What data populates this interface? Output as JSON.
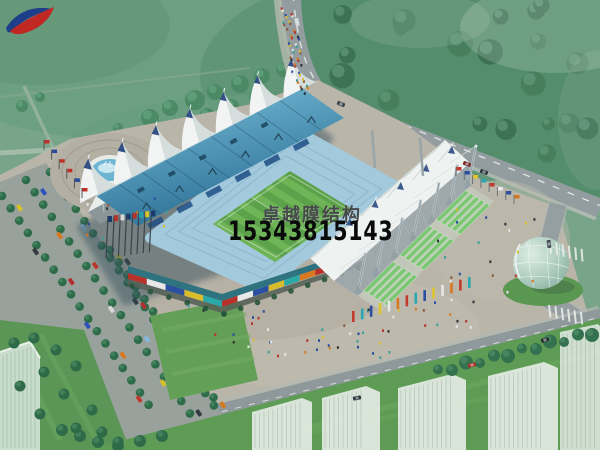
{
  "watermark": {
    "logo_icon": "swoosh-bird-logo-icon",
    "company_name": "卓越膜结构",
    "phone_number": "15343815143",
    "company_text_color": "#45494b",
    "phone_text_color": "#0a0a0a"
  },
  "scene": {
    "type": "architectural-aerial-rendering",
    "subject": "membrane-roof-stadium-complex",
    "palette": {
      "meadow_green": "#74a487",
      "forest_green": "#4c8a66",
      "road_gray": "#939da0",
      "plaza_tan": "#b9b5a9",
      "roof_blue_light": "#7fc3de",
      "roof_blue_dark": "#2a6f94",
      "membrane_white": "#eef2f0",
      "stand_blue": "#a3c9dd",
      "field_green_dark": "#5ba24b",
      "field_green_light": "#6fb557",
      "terrace_green": "#7cc774",
      "fountain_water_blue": "#6db5d3",
      "glass_egg_green": "#9cc3b8",
      "membrane_finial_navy": "#1e3f7a"
    }
  }
}
